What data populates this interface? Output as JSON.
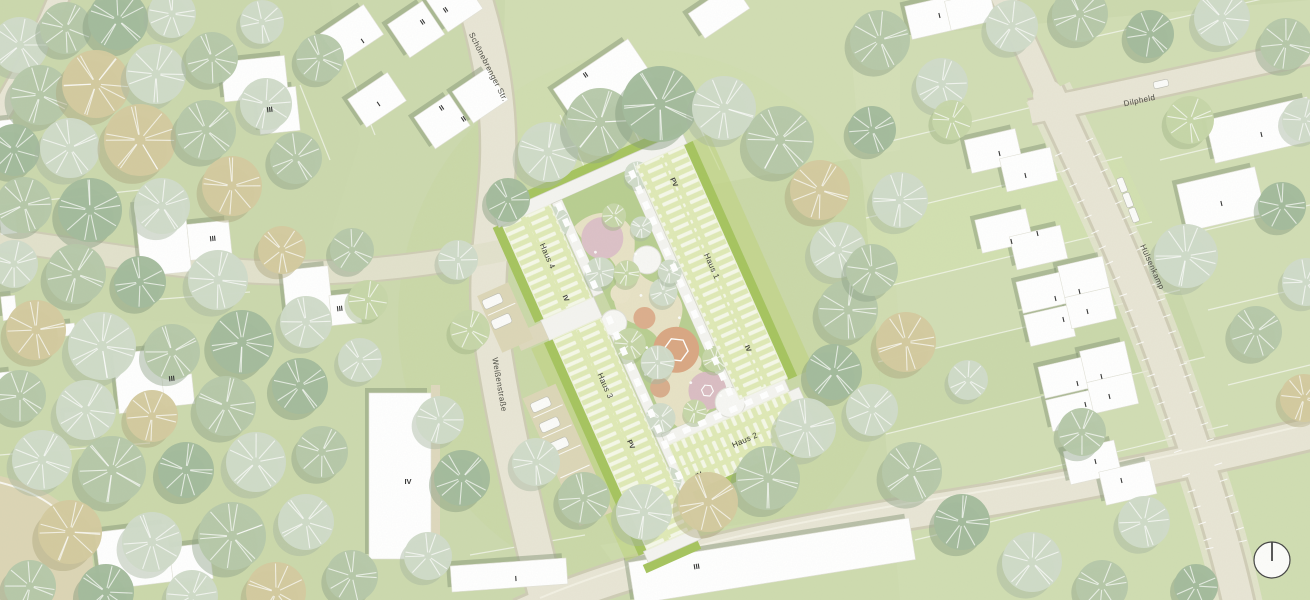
{
  "map": {
    "kind": "landscape architecture site plan",
    "streets": [
      {
        "name": "Schönebrenger Str."
      },
      {
        "name": "Dilpheld"
      },
      {
        "name": "Hülsenkamp"
      },
      {
        "name": "Weißenstraße"
      }
    ],
    "site": {
      "houses": [
        {
          "name": "Haus 1",
          "storeys": "IV",
          "roof": "PV"
        },
        {
          "name": "Haus 2",
          "storeys": "IV"
        },
        {
          "name": "Haus 3",
          "storeys": "IV",
          "roof": "PV"
        },
        {
          "name": "Haus 4",
          "storeys": "IV"
        }
      ]
    },
    "storey_labels": {
      "I": "I",
      "II": "II",
      "III": "III",
      "IV": "IV"
    },
    "colors": {
      "lawn": "#ccd9ae",
      "road": "#e8e5d5",
      "building": "#ffffff",
      "roof_green": "#dfe9b6",
      "hedge": "#a6c45f",
      "play_pink": "#dcc1c7",
      "play_terracotta": "#d9a783",
      "tree_sage": "#b6c8a9",
      "tree_pale": "#cfdbc9",
      "tree_tan": "#d4ca9f"
    }
  }
}
